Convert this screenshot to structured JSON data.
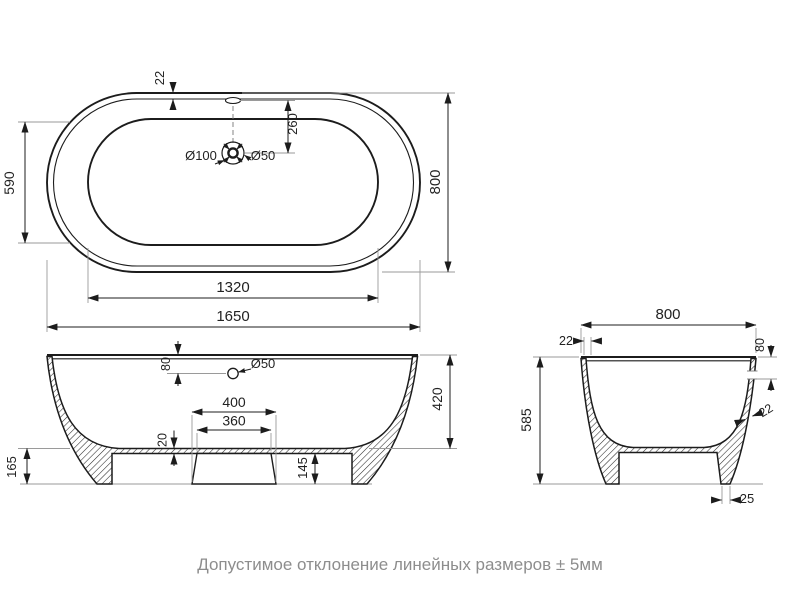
{
  "page": {
    "caption": "Допустимое отклонение линейных размеров ± 5мм"
  },
  "colors": {
    "line": "#1c1c1c",
    "extension_line": "#9a9a9a",
    "caption_text": "#8d8d8d",
    "background": "#ffffff"
  },
  "views": {
    "top": {
      "overall_length": "1650",
      "overall_width": "800",
      "basin_length": "1320",
      "basin_width": "590",
      "rim_width": "22",
      "drain_offset": "260",
      "drain_diameter": "Ø100",
      "waste_diameter": "Ø50"
    },
    "front": {
      "inner_depth": "420",
      "overflow_offset": "80",
      "overflow_diameter": "Ø50",
      "plinth_bottom_width": "400",
      "plinth_top_width": "360",
      "floor_thickness": "20",
      "recess_height": "145",
      "base_height": "165"
    },
    "side": {
      "overall_width": "800",
      "height": "585",
      "rim_thickness": "22",
      "overflow_offset": "80",
      "wall_thickness": "22",
      "foot_width": "25"
    }
  }
}
